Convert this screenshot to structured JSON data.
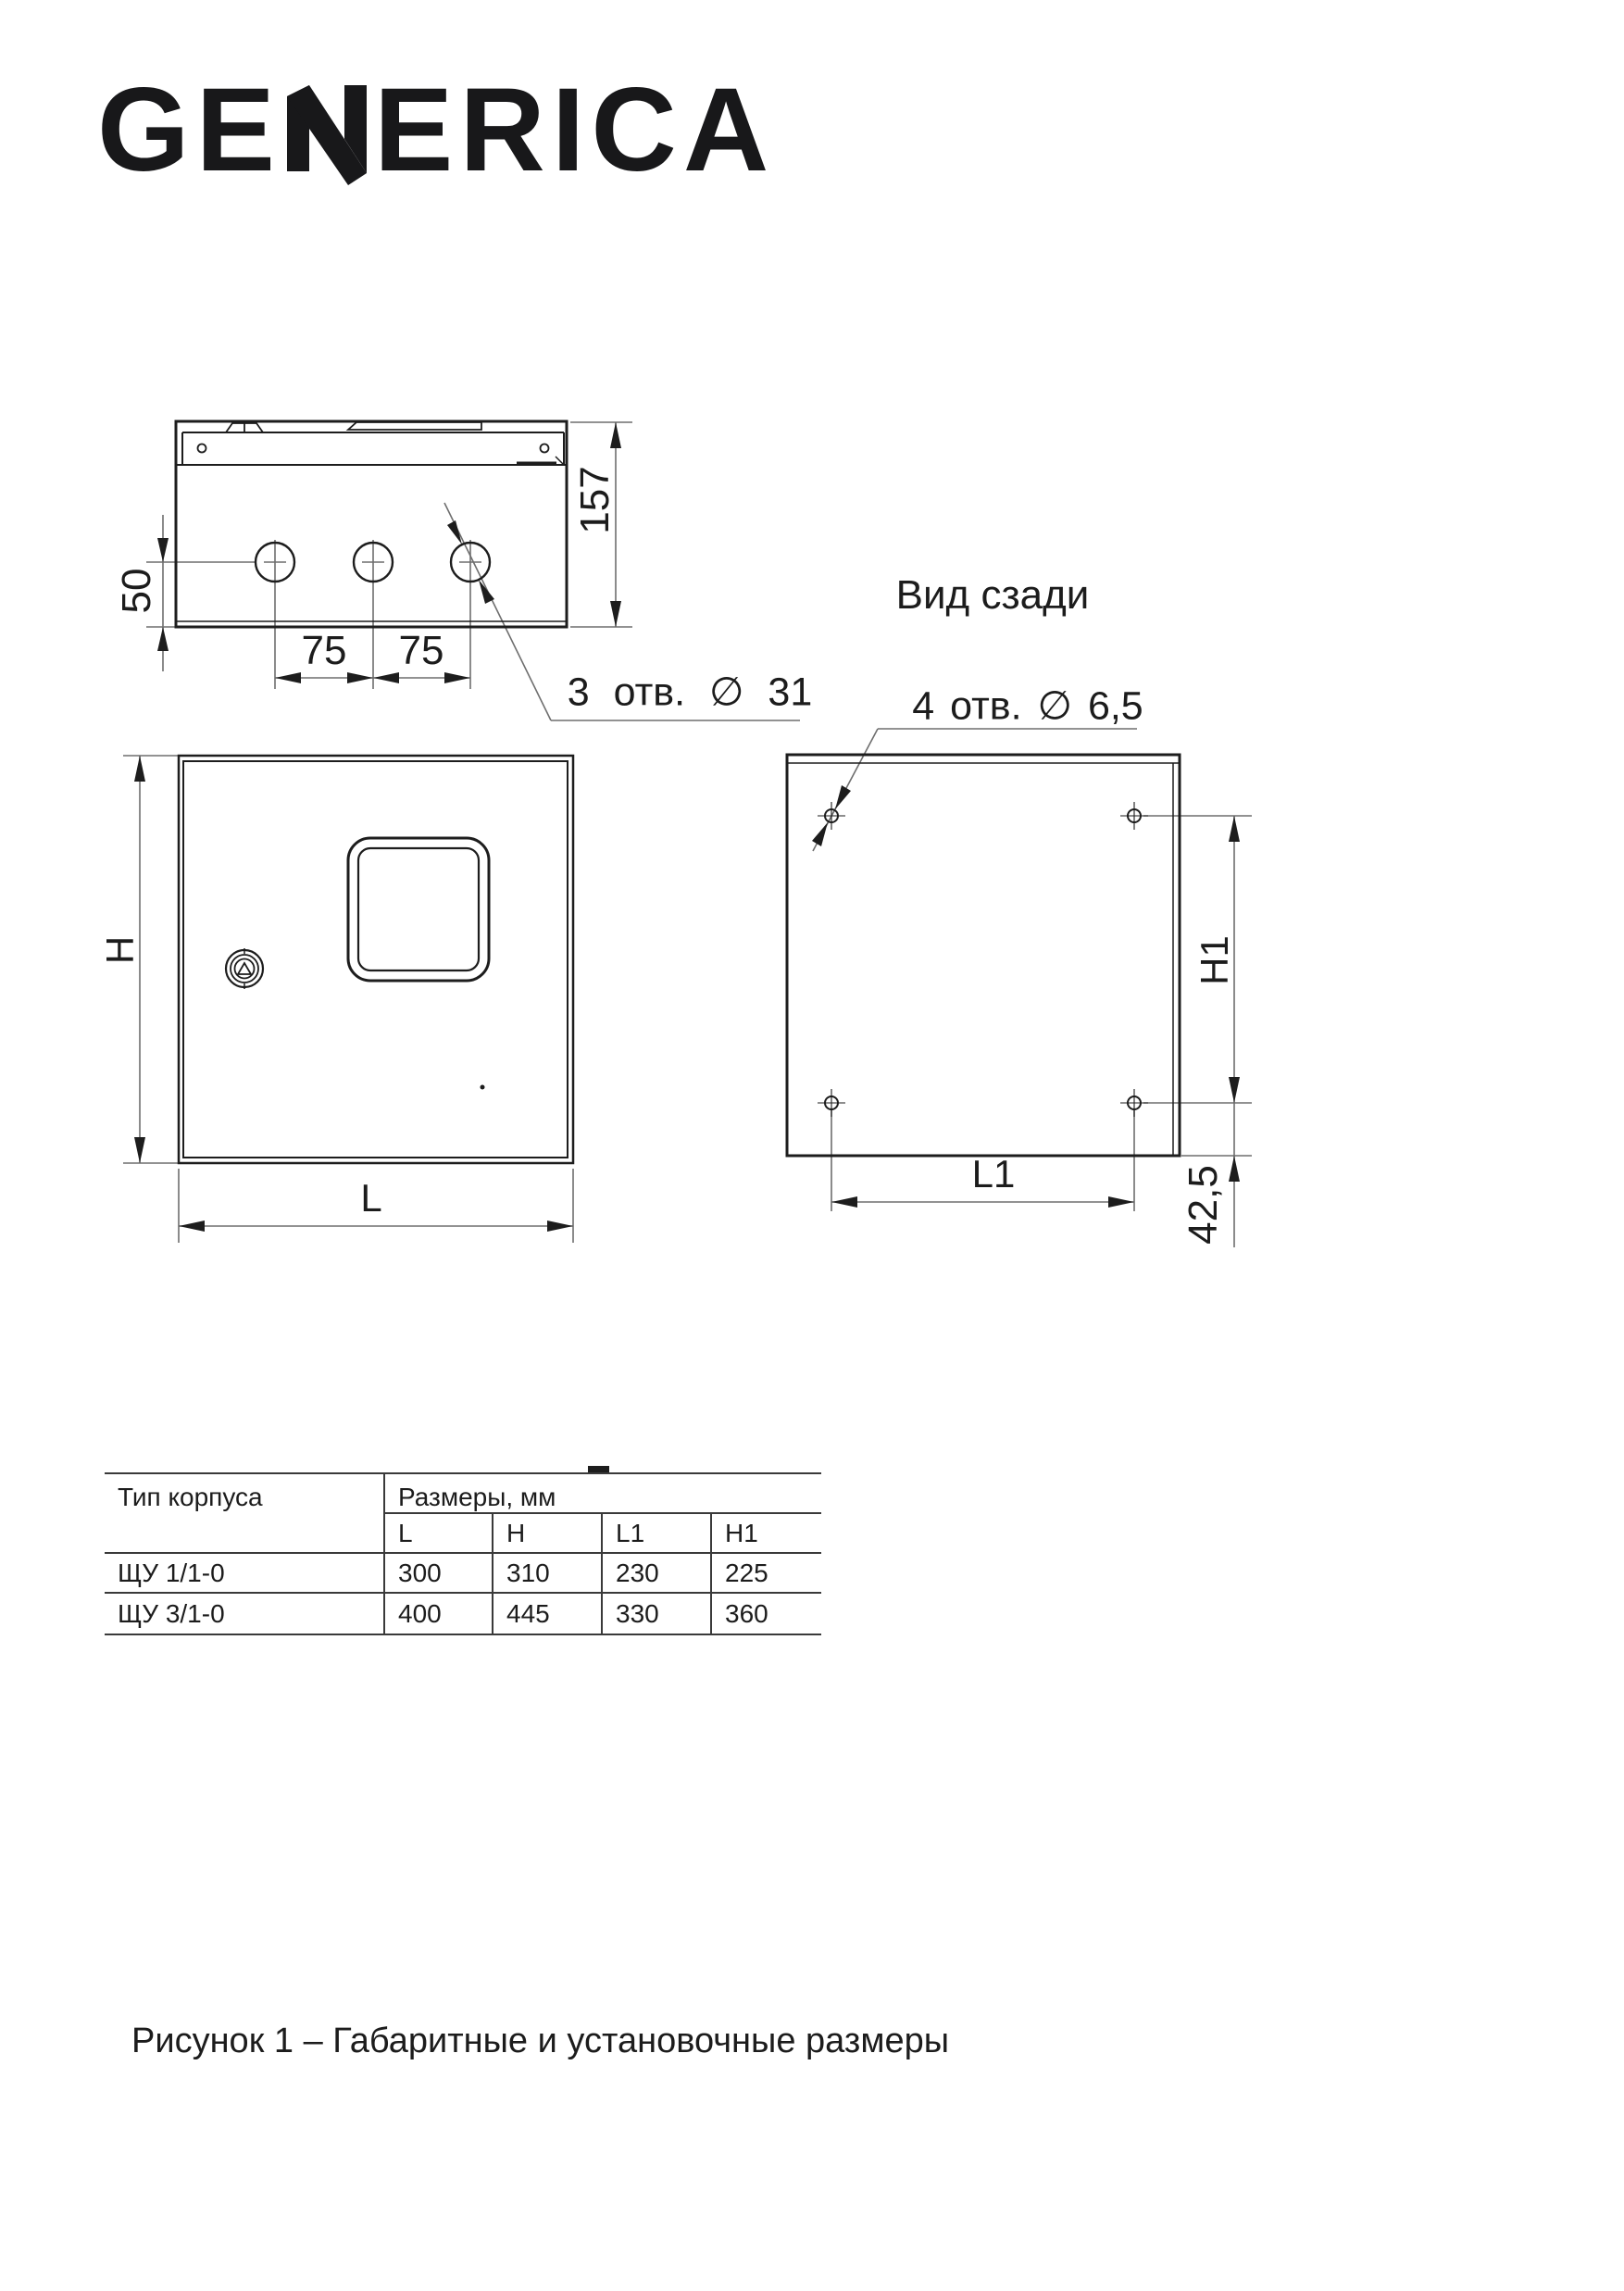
{
  "brand": {
    "logo_text": "GENERICA",
    "logo_pre": "GE",
    "logo_post": "ERICA"
  },
  "drawing": {
    "top_view": {
      "dim_depth": "157",
      "dim_hole_offset": "50",
      "dim_hole_spacing_a": "75",
      "dim_hole_spacing_b": "75",
      "holes_callout": "3 отв. ∅ 31"
    },
    "front_view": {
      "dim_height_label": "H",
      "dim_width_label": "L"
    },
    "rear_view": {
      "title": "Вид сзади",
      "holes_callout": "4 отв. ∅ 6,5",
      "dim_height_label": "H1",
      "dim_width_label": "L1",
      "dim_bottom_offset": "42,5"
    }
  },
  "table": {
    "col1_header": "Тип корпуса",
    "col2_header": "Размеры, мм",
    "sub_headers": [
      "L",
      "H",
      "L1",
      "H1"
    ],
    "rows": [
      {
        "type": "ЩУ 1/1-0",
        "values": [
          "300",
          "310",
          "230",
          "225"
        ]
      },
      {
        "type": "ЩУ 3/1-0",
        "values": [
          "400",
          "445",
          "330",
          "360"
        ]
      }
    ]
  },
  "caption": "Рисунок 1 – Габаритные и установочные размеры"
}
